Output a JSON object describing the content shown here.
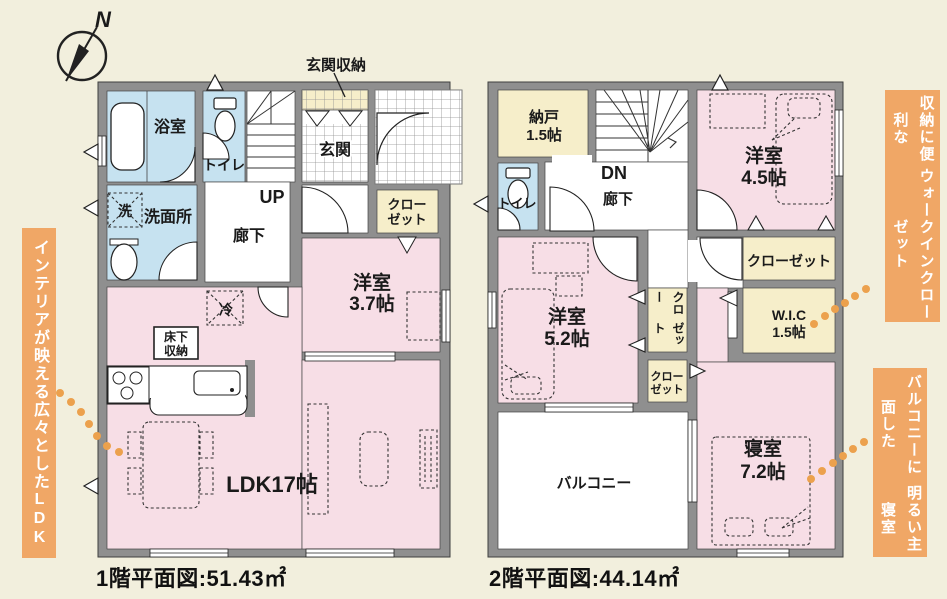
{
  "compass": {
    "north": "N"
  },
  "banners": {
    "left": "インテリアが映える広々としたLDK",
    "right_top_col1": "収納に便利な",
    "right_top_col2": "ウォークインクローゼット",
    "right_bottom_col1": "バルコニーに面した",
    "right_bottom_col2": "明るい主寝室"
  },
  "floor1": {
    "title": "1階平面図:51.43㎡",
    "rooms": {
      "bath": "浴室",
      "toilet": "トイレ",
      "washroom": "洗面所",
      "washer_mark": "洗",
      "hallway": "廊下",
      "stairs": "UP",
      "entrance": "玄関",
      "entrance_storage": "玄関収納",
      "closet_l1": "クロー",
      "closet_l2": "ゼット",
      "western_name": "洋室",
      "western_size": "3.7帖",
      "fridge_mark": "冷",
      "underfloor_l1": "床下",
      "underfloor_l2": "収納",
      "ldk": "LDK17帖"
    }
  },
  "floor2": {
    "title": "2階平面図:44.14㎡",
    "rooms": {
      "storeroom_name": "納戸",
      "storeroom_size": "1.5帖",
      "toilet": "トイレ",
      "stairs": "DN",
      "hallway": "廊下",
      "western45_name": "洋室",
      "western45_size": "4.5帖",
      "closet": "クローゼット",
      "closet_v_col1": "クロー",
      "closet_v_col2": "ゼット",
      "closet_small_l1": "クロー",
      "closet_small_l2": "ゼット",
      "wic_name": "W.I.C",
      "wic_size": "1.5帖",
      "western52_name": "洋室",
      "western52_size": "5.2帖",
      "bedroom_name": "寝室",
      "bedroom_size": "7.2帖",
      "balcony": "バルコニー"
    }
  },
  "colors": {
    "background": "#f2efdd",
    "wall_gray": "#8f8f8f",
    "room_pink": "#f7dee6",
    "room_blue": "#c6e2f0",
    "room_cream": "#f6eeca",
    "accent_orange": "#f0a766",
    "dot_orange": "#eca14d",
    "text": "#1a1a1a"
  }
}
